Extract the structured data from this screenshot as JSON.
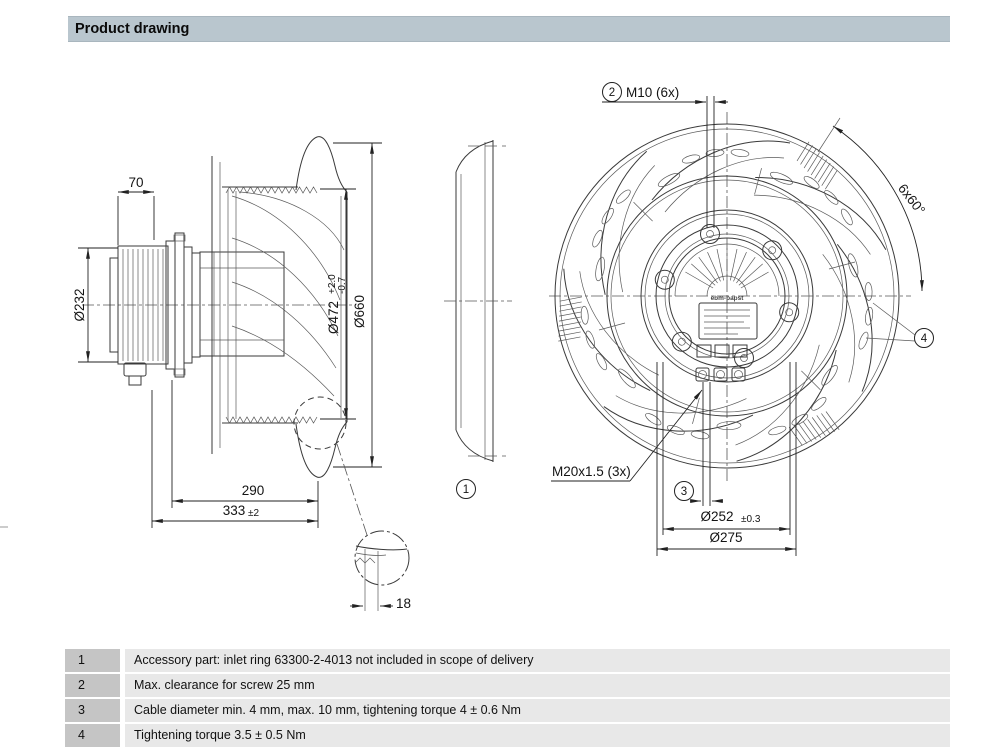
{
  "header": {
    "title": "Product drawing"
  },
  "drawing": {
    "side_view": {
      "dim_motor_depth": "70",
      "dim_motor_diameter": "Ø232",
      "dim_impeller_diameter": "Ø472",
      "dim_impeller_tol_plus": "+2.0",
      "dim_impeller_tol_minus": "-0.7",
      "dim_overall_diameter": "Ø660",
      "dim_depth_housing": "290",
      "dim_depth_overall": "333",
      "dim_depth_overall_tol": "±2",
      "dim_inlet_ring": "18"
    },
    "inlet_view": {
      "callout": "1"
    },
    "back_view": {
      "callout_bolts": "2",
      "label_bolts": "M10 (6x)",
      "label_bolt_angle": "6x60°",
      "callout_gland": "3",
      "label_gland": "M20x1.5 (3x)",
      "callout_screw": "4",
      "dim_bolt_circle": "Ø252",
      "dim_bolt_circle_tol": "±0.3",
      "dim_pitch_circle": "Ø275",
      "brand": "ebm-papst"
    }
  },
  "notes": [
    {
      "num": "1",
      "text": "Accessory part: inlet ring 63300-2-4013 not included in scope of delivery"
    },
    {
      "num": "2",
      "text": "Max. clearance for screw 25 mm"
    },
    {
      "num": "3",
      "text": "Cable diameter min. 4 mm, max. 10 mm, tightening torque 4 ± 0.6 Nm"
    },
    {
      "num": "4",
      "text": "Tightening torque 3.5 ± 0.5 Nm"
    }
  ],
  "colors": {
    "header_bg": "#b9c6ce",
    "note_num_bg": "#c5c5c5",
    "note_row_bg": "#e8e8e8",
    "line": "#3a3a3a"
  }
}
